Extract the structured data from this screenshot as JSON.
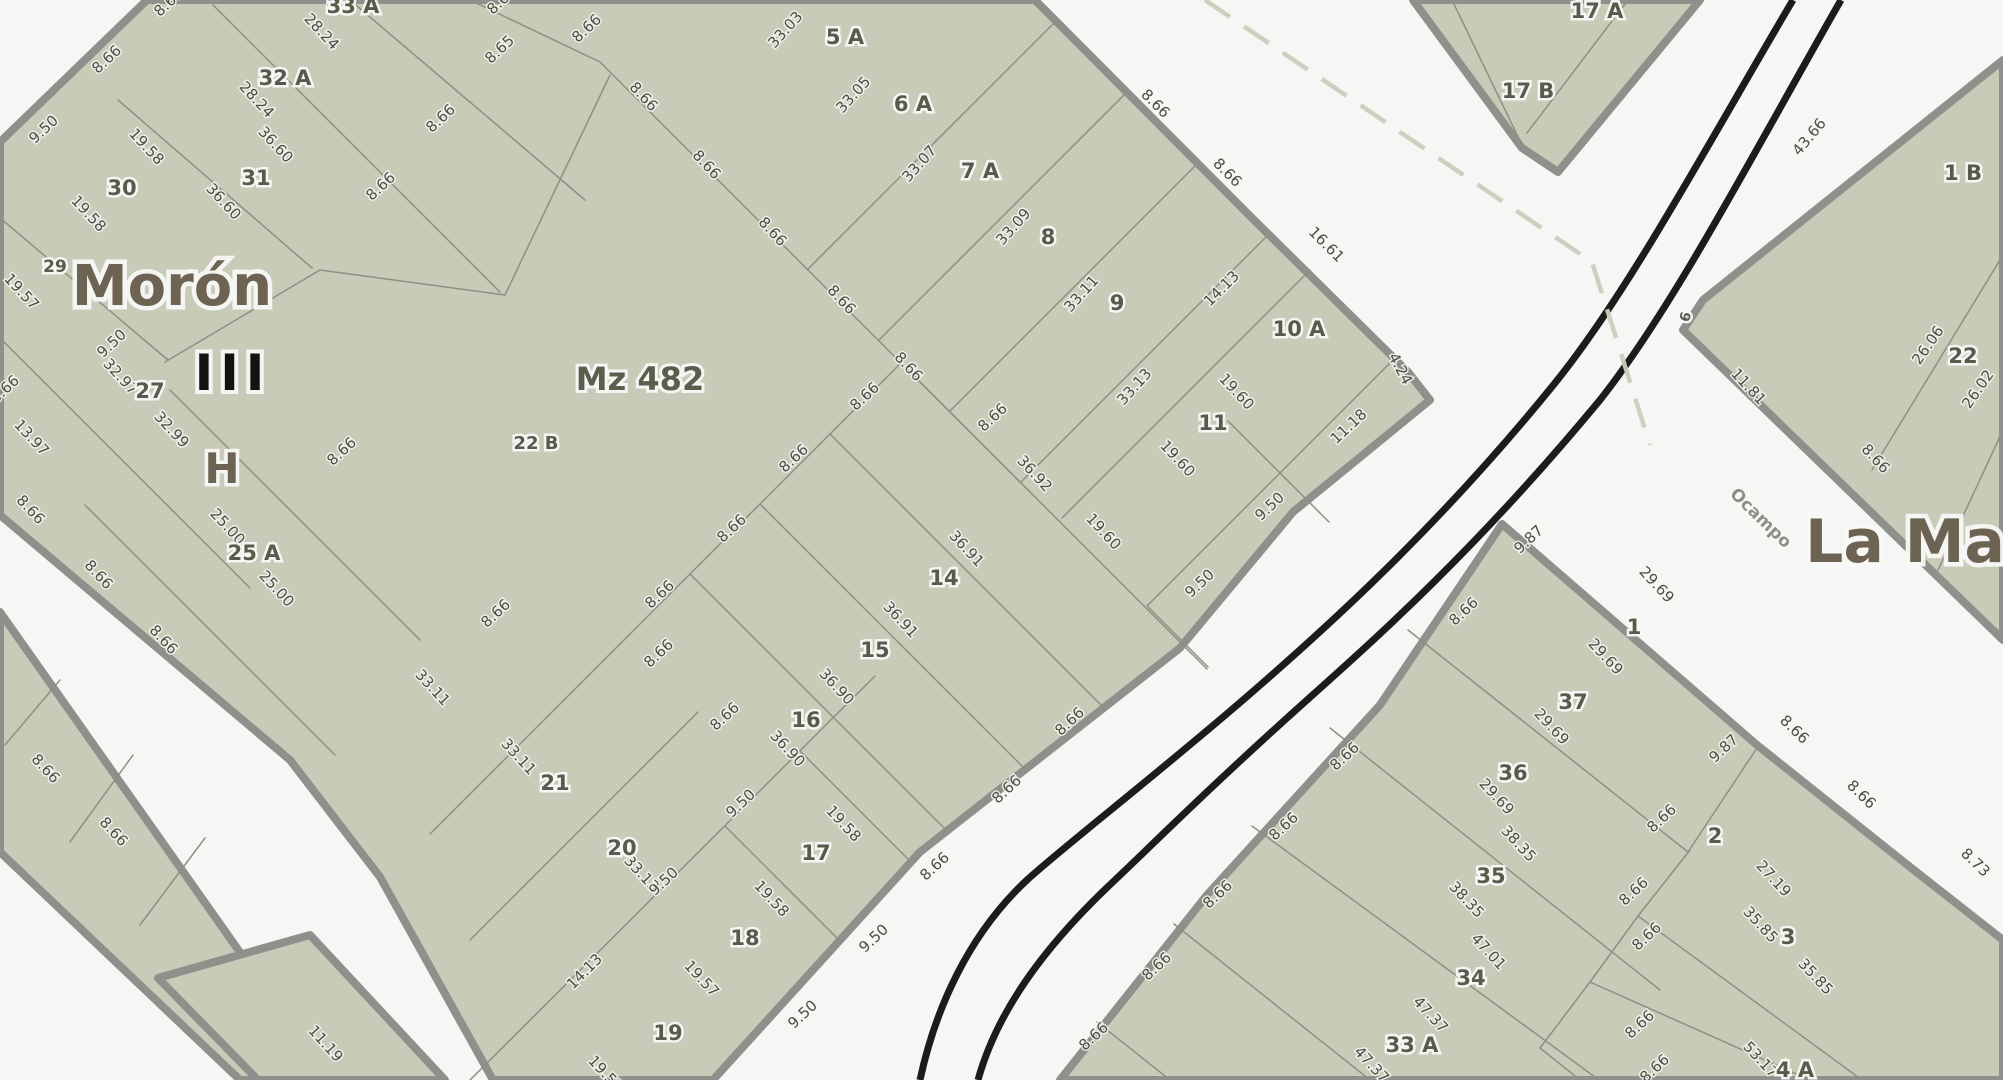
{
  "map": {
    "colors": {
      "street_bg": "#f6f6f4",
      "block_fill": "#c9cbb9",
      "block_casing": "#8f8f8b",
      "lot_line": "#8f9081",
      "railway": "#1c1c1c",
      "boundary_dash": "#c9cdbc",
      "measurement_text": "#4d4d42",
      "parcel_text": "#5a5a4c",
      "region_text": "#6d6352",
      "street_text": "#8f8f88"
    },
    "region_labels": [
      {
        "text": "Morón",
        "x": 172,
        "y": 305,
        "size": 56,
        "color": "#6d6352",
        "rot": 0,
        "halo": 9
      },
      {
        "text": "III",
        "x": 233,
        "y": 390,
        "size": 50,
        "color": "#121212",
        "rot": 0,
        "halo": 8,
        "spacing": 7
      },
      {
        "text": "H",
        "x": 222,
        "y": 483,
        "size": 42,
        "color": "#6d6352",
        "rot": 0,
        "halo": 7
      },
      {
        "text": "Mz 482",
        "x": 640,
        "y": 390,
        "size": 32,
        "color": "#5d5d4d",
        "rot": 0,
        "halo": 6
      },
      {
        "text": "La Ma",
        "x": 1905,
        "y": 562,
        "size": 60,
        "color": "#6d6352",
        "rot": 0,
        "halo": 9
      }
    ],
    "street_labels": [
      {
        "text": "Ocampo",
        "x": 1757,
        "y": 522,
        "size": 17,
        "rot": 44
      }
    ],
    "parcel_labels": [
      {
        "text": "33 A",
        "x": 353,
        "y": 13
      },
      {
        "text": "32 A",
        "x": 285,
        "y": 85
      },
      {
        "text": "31",
        "x": 256,
        "y": 185
      },
      {
        "text": "30",
        "x": 122,
        "y": 195
      },
      {
        "text": "29",
        "x": 55,
        "y": 272,
        "size": 17
      },
      {
        "text": "27",
        "x": 150,
        "y": 398
      },
      {
        "text": "25 A",
        "x": 254,
        "y": 560
      },
      {
        "text": "22 B",
        "x": 536,
        "y": 449,
        "size": 18
      },
      {
        "text": "5 A",
        "x": 845,
        "y": 44
      },
      {
        "text": "6 A",
        "x": 913,
        "y": 111
      },
      {
        "text": "7 A",
        "x": 980,
        "y": 178
      },
      {
        "text": "8",
        "x": 1048,
        "y": 244
      },
      {
        "text": "9",
        "x": 1117,
        "y": 310
      },
      {
        "text": "10 A",
        "x": 1299,
        "y": 336
      },
      {
        "text": "11",
        "x": 1213,
        "y": 430
      },
      {
        "text": "14",
        "x": 944,
        "y": 585
      },
      {
        "text": "15",
        "x": 875,
        "y": 657
      },
      {
        "text": "16",
        "x": 806,
        "y": 727
      },
      {
        "text": "17",
        "x": 816,
        "y": 860
      },
      {
        "text": "18",
        "x": 745,
        "y": 945
      },
      {
        "text": "19",
        "x": 668,
        "y": 1040
      },
      {
        "text": "20",
        "x": 622,
        "y": 855
      },
      {
        "text": "21",
        "x": 555,
        "y": 790
      },
      {
        "text": "17 A",
        "x": 1597,
        "y": 18
      },
      {
        "text": "17 B",
        "x": 1528,
        "y": 98
      },
      {
        "text": "1 B",
        "x": 1963,
        "y": 180
      },
      {
        "text": "22",
        "x": 1963,
        "y": 363
      },
      {
        "text": "6",
        "x": 1690,
        "y": 318,
        "size": 14,
        "rot": -75
      },
      {
        "text": "1",
        "x": 1634,
        "y": 634
      },
      {
        "text": "37",
        "x": 1573,
        "y": 709
      },
      {
        "text": "36",
        "x": 1513,
        "y": 780
      },
      {
        "text": "35",
        "x": 1491,
        "y": 883
      },
      {
        "text": "34",
        "x": 1471,
        "y": 985
      },
      {
        "text": "33 A",
        "x": 1412,
        "y": 1052
      },
      {
        "text": "2",
        "x": 1715,
        "y": 843
      },
      {
        "text": "3",
        "x": 1788,
        "y": 944
      },
      {
        "text": "4 A",
        "x": 1795,
        "y": 1077
      }
    ],
    "measurement_labels": [
      {
        "text": "8.66",
        "x": 172,
        "y": 6,
        "rot": -43
      },
      {
        "text": "8.66",
        "x": 110,
        "y": 63,
        "rot": -43
      },
      {
        "text": "9.50",
        "x": 47,
        "y": 133,
        "rot": -43
      },
      {
        "text": "28.24",
        "x": 318,
        "y": 35,
        "rot": 47
      },
      {
        "text": "28.24",
        "x": 253,
        "y": 103,
        "rot": 47
      },
      {
        "text": "36.60",
        "x": 272,
        "y": 148,
        "rot": 47
      },
      {
        "text": "36.60",
        "x": 220,
        "y": 205,
        "rot": 47
      },
      {
        "text": "19.58",
        "x": 143,
        "y": 150,
        "rot": 47
      },
      {
        "text": "19.58",
        "x": 85,
        "y": 217,
        "rot": 47
      },
      {
        "text": "19.57",
        "x": 18,
        "y": 295,
        "rot": 47
      },
      {
        "text": "9.50",
        "x": 115,
        "y": 347,
        "rot": -43
      },
      {
        "text": "32.97",
        "x": 117,
        "y": 380,
        "rot": 47
      },
      {
        "text": "32.99",
        "x": 168,
        "y": 433,
        "rot": 47
      },
      {
        "text": "13.97",
        "x": 28,
        "y": 441,
        "rot": 47
      },
      {
        "text": "8.66",
        "x": 8,
        "y": 393,
        "rot": -43
      },
      {
        "text": "8.66",
        "x": 444,
        "y": 122,
        "rot": -43
      },
      {
        "text": "8.66",
        "x": 384,
        "y": 190,
        "rot": -43
      },
      {
        "text": "8.65",
        "x": 503,
        "y": 53,
        "rot": -43
      },
      {
        "text": "8.66",
        "x": 505,
        "y": 4,
        "rot": -43
      },
      {
        "text": "8.66",
        "x": 590,
        "y": 32,
        "rot": -43
      },
      {
        "text": "25.00",
        "x": 224,
        "y": 530,
        "rot": 47
      },
      {
        "text": "25.00",
        "x": 273,
        "y": 592,
        "rot": 47
      },
      {
        "text": "8.66",
        "x": 345,
        "y": 455,
        "rot": -43
      },
      {
        "text": "8.66",
        "x": 27,
        "y": 513,
        "rot": 47
      },
      {
        "text": "8.66",
        "x": 95,
        "y": 578,
        "rot": 47
      },
      {
        "text": "8.66",
        "x": 160,
        "y": 643,
        "rot": 47
      },
      {
        "text": "33.03",
        "x": 789,
        "y": 33,
        "rot": -48
      },
      {
        "text": "33.05",
        "x": 857,
        "y": 98,
        "rot": -48
      },
      {
        "text": "33.07",
        "x": 923,
        "y": 167,
        "rot": -48
      },
      {
        "text": "33.09",
        "x": 1017,
        "y": 230,
        "rot": -48
      },
      {
        "text": "33.11",
        "x": 1085,
        "y": 297,
        "rot": -48
      },
      {
        "text": "33.13",
        "x": 1138,
        "y": 390,
        "rot": -48
      },
      {
        "text": "8.66",
        "x": 640,
        "y": 100,
        "rot": 47
      },
      {
        "text": "8.66",
        "x": 703,
        "y": 168,
        "rot": 47
      },
      {
        "text": "8.66",
        "x": 769,
        "y": 235,
        "rot": 47
      },
      {
        "text": "8.66",
        "x": 838,
        "y": 303,
        "rot": 47
      },
      {
        "text": "8.66",
        "x": 905,
        "y": 370,
        "rot": 47
      },
      {
        "text": "8.66",
        "x": 1152,
        "y": 107,
        "rot": 45
      },
      {
        "text": "8.66",
        "x": 1224,
        "y": 176,
        "rot": 45
      },
      {
        "text": "16.61",
        "x": 1323,
        "y": 248,
        "rot": 45
      },
      {
        "text": "14.13",
        "x": 1225,
        "y": 292,
        "rot": -45
      },
      {
        "text": "4.24",
        "x": 1396,
        "y": 371,
        "rot": 62
      },
      {
        "text": "11.18",
        "x": 1352,
        "y": 430,
        "rot": -43
      },
      {
        "text": "9.50",
        "x": 1273,
        "y": 510,
        "rot": -43
      },
      {
        "text": "9.50",
        "x": 1203,
        "y": 587,
        "rot": -43
      },
      {
        "text": "19.60",
        "x": 1233,
        "y": 395,
        "rot": 47
      },
      {
        "text": "19.60",
        "x": 1174,
        "y": 462,
        "rot": 47
      },
      {
        "text": "19.60",
        "x": 1100,
        "y": 535,
        "rot": 47
      },
      {
        "text": "36.92",
        "x": 1031,
        "y": 477,
        "rot": 47
      },
      {
        "text": "36.91",
        "x": 963,
        "y": 552,
        "rot": 47
      },
      {
        "text": "36.91",
        "x": 897,
        "y": 623,
        "rot": 47
      },
      {
        "text": "36.90",
        "x": 833,
        "y": 690,
        "rot": 47
      },
      {
        "text": "36.90",
        "x": 784,
        "y": 752,
        "rot": 47
      },
      {
        "text": "8.66",
        "x": 996,
        "y": 421,
        "rot": -43
      },
      {
        "text": "8.66",
        "x": 868,
        "y": 400,
        "rot": -43
      },
      {
        "text": "8.66",
        "x": 797,
        "y": 462,
        "rot": -43
      },
      {
        "text": "8.66",
        "x": 735,
        "y": 532,
        "rot": -43
      },
      {
        "text": "8.66",
        "x": 663,
        "y": 598,
        "rot": -43
      },
      {
        "text": "8.66",
        "x": 499,
        "y": 617,
        "rot": -43
      },
      {
        "text": "8.66",
        "x": 662,
        "y": 657,
        "rot": -43
      },
      {
        "text": "8.66",
        "x": 728,
        "y": 720,
        "rot": -43
      },
      {
        "text": "33.11",
        "x": 429,
        "y": 691,
        "rot": 47
      },
      {
        "text": "33.11",
        "x": 515,
        "y": 760,
        "rot": 47
      },
      {
        "text": "33.13",
        "x": 638,
        "y": 877,
        "rot": 47
      },
      {
        "text": "9.50",
        "x": 744,
        "y": 807,
        "rot": -43
      },
      {
        "text": "9.50",
        "x": 667,
        "y": 885,
        "rot": -43
      },
      {
        "text": "19.58",
        "x": 840,
        "y": 827,
        "rot": 47
      },
      {
        "text": "19.58",
        "x": 768,
        "y": 902,
        "rot": 47
      },
      {
        "text": "19.57",
        "x": 698,
        "y": 982,
        "rot": 47
      },
      {
        "text": "14.13",
        "x": 588,
        "y": 975,
        "rot": -45
      },
      {
        "text": "19.57",
        "x": 602,
        "y": 1077,
        "rot": 47
      },
      {
        "text": "8.66",
        "x": 1073,
        "y": 725,
        "rot": -43
      },
      {
        "text": "8.66",
        "x": 1010,
        "y": 793,
        "rot": -43
      },
      {
        "text": "8.66",
        "x": 938,
        "y": 870,
        "rot": -43
      },
      {
        "text": "9.50",
        "x": 877,
        "y": 942,
        "rot": -43
      },
      {
        "text": "9.50",
        "x": 806,
        "y": 1018,
        "rot": -43
      },
      {
        "text": "8.66",
        "x": 42,
        "y": 772,
        "rot": 47
      },
      {
        "text": "8.66",
        "x": 110,
        "y": 835,
        "rot": 47
      },
      {
        "text": "11.19",
        "x": 322,
        "y": 1047,
        "rot": 48
      },
      {
        "text": "43.66",
        "x": 1813,
        "y": 140,
        "rot": -50
      },
      {
        "text": "26.06",
        "x": 1932,
        "y": 348,
        "rot": -55
      },
      {
        "text": "26.02",
        "x": 1982,
        "y": 392,
        "rot": -55
      },
      {
        "text": "11.81",
        "x": 1745,
        "y": 390,
        "rot": 47
      },
      {
        "text": "8.66",
        "x": 1872,
        "y": 462,
        "rot": 47
      },
      {
        "text": "9.87",
        "x": 1532,
        "y": 543,
        "rot": -43
      },
      {
        "text": "8.66",
        "x": 1467,
        "y": 615,
        "rot": -43
      },
      {
        "text": "8.66",
        "x": 1348,
        "y": 760,
        "rot": -43
      },
      {
        "text": "8.66",
        "x": 1287,
        "y": 830,
        "rot": -43
      },
      {
        "text": "8.66",
        "x": 1221,
        "y": 898,
        "rot": -43
      },
      {
        "text": "8.66",
        "x": 1160,
        "y": 970,
        "rot": -43
      },
      {
        "text": "8.66",
        "x": 1097,
        "y": 1040,
        "rot": -43
      },
      {
        "text": "9.87",
        "x": 1727,
        "y": 752,
        "rot": -43
      },
      {
        "text": "8.66",
        "x": 1791,
        "y": 733,
        "rot": 44
      },
      {
        "text": "8.66",
        "x": 1858,
        "y": 798,
        "rot": 44
      },
      {
        "text": "8.73",
        "x": 1972,
        "y": 866,
        "rot": 44
      },
      {
        "text": "29.69",
        "x": 1653,
        "y": 588,
        "rot": 47
      },
      {
        "text": "29.69",
        "x": 1602,
        "y": 660,
        "rot": 47
      },
      {
        "text": "29.69",
        "x": 1548,
        "y": 730,
        "rot": 47
      },
      {
        "text": "29.69",
        "x": 1493,
        "y": 800,
        "rot": 47
      },
      {
        "text": "38.35",
        "x": 1515,
        "y": 847,
        "rot": 47
      },
      {
        "text": "38.35",
        "x": 1463,
        "y": 903,
        "rot": 47
      },
      {
        "text": "47.01",
        "x": 1485,
        "y": 955,
        "rot": 47
      },
      {
        "text": "47.37",
        "x": 1427,
        "y": 1018,
        "rot": 47
      },
      {
        "text": "47.37",
        "x": 1368,
        "y": 1068,
        "rot": 47
      },
      {
        "text": "8.66",
        "x": 1665,
        "y": 822,
        "rot": -43
      },
      {
        "text": "8.66",
        "x": 1637,
        "y": 895,
        "rot": -43
      },
      {
        "text": "8.66",
        "x": 1650,
        "y": 940,
        "rot": -43
      },
      {
        "text": "8.66",
        "x": 1643,
        "y": 1028,
        "rot": -43
      },
      {
        "text": "8.66",
        "x": 1658,
        "y": 1072,
        "rot": -43
      },
      {
        "text": "27.19",
        "x": 1770,
        "y": 882,
        "rot": 47
      },
      {
        "text": "35.85",
        "x": 1757,
        "y": 928,
        "rot": 47
      },
      {
        "text": "35.85",
        "x": 1812,
        "y": 980,
        "rot": 47
      },
      {
        "text": "53.17",
        "x": 1757,
        "y": 1063,
        "rot": 47
      }
    ],
    "blocks": [
      {
        "name": "block-mz482",
        "d": "M0,142 L147,0 L1035,0 L1252,218 L1408,372 L1430,400 L1293,512 L1180,648 L920,852 L713,1080 L493,1080 L380,877 L290,760 L0,515 Z"
      },
      {
        "name": "block-sw-strip",
        "d": "M0,612 L330,1080 L240,1080 L0,852 Z"
      },
      {
        "name": "block-sw-corner",
        "d": "M310,935 L445,1080 L258,1080 L158,978 Z"
      },
      {
        "name": "block-northeast",
        "d": "M1413,0 L1700,0 L1558,172 L1522,148 Z"
      },
      {
        "name": "block-east-1b22",
        "d": "M2003,60 L1703,300 L1683,330 L2003,640 Z"
      },
      {
        "name": "block-southeast",
        "d": "M1502,524 L1757,745 L1905,863 L2003,940 L2003,1080 L1060,1080 L1207,895 L1380,705 Z"
      }
    ],
    "inner_lines": [
      [
        600,
        62,
        1030,
        492
      ],
      [
        1056,
        21,
        808,
        269
      ],
      [
        1127,
        92,
        879,
        340
      ],
      [
        1198,
        163,
        950,
        411
      ],
      [
        1269,
        234,
        1021,
        482
      ],
      [
        1310,
        270,
        1062,
        518
      ],
      [
        1395,
        358,
        1147,
        606
      ],
      [
        1228,
        421,
        1329,
        522
      ],
      [
        1147,
        606,
        1208,
        667
      ],
      [
        901,
        363,
        430,
        834
      ],
      [
        901,
        363,
        1207,
        669
      ],
      [
        830,
        434,
        1104,
        708
      ],
      [
        760,
        504,
        1026,
        770
      ],
      [
        690,
        574,
        947,
        831
      ],
      [
        875,
        676,
        470,
        1080
      ],
      [
        800,
        751,
        911,
        862
      ],
      [
        725,
        826,
        840,
        941
      ],
      [
        698,
        712,
        470,
        940
      ],
      [
        0,
        218,
        168,
        360
      ],
      [
        118,
        100,
        312,
        268
      ],
      [
        213,
        5,
        500,
        292
      ],
      [
        350,
        0,
        585,
        200
      ],
      [
        470,
        0,
        600,
        62
      ],
      [
        165,
        362,
        320,
        270
      ],
      [
        320,
        270,
        505,
        295
      ],
      [
        505,
        295,
        610,
        75
      ],
      [
        0,
        338,
        250,
        588
      ],
      [
        170,
        390,
        420,
        640
      ],
      [
        85,
        505,
        335,
        755
      ],
      [
        60,
        680,
        5,
        745
      ],
      [
        133,
        755,
        70,
        842
      ],
      [
        205,
        838,
        140,
        925
      ],
      [
        1628,
        0,
        1527,
        133
      ],
      [
        1452,
        0,
        1521,
        143
      ],
      [
        1872,
        470,
        2003,
        255
      ],
      [
        1938,
        570,
        2003,
        430
      ],
      [
        1408,
        630,
        1688,
        852
      ],
      [
        1688,
        852,
        1757,
        748
      ],
      [
        1330,
        728,
        1660,
        990
      ],
      [
        1252,
        826,
        1599,
        1080
      ],
      [
        1174,
        924,
        1370,
        1080
      ],
      [
        1097,
        1022,
        1170,
        1080
      ],
      [
        1690,
        850,
        1638,
        916
      ],
      [
        1638,
        916,
        1862,
        1080
      ],
      [
        1638,
        916,
        1590,
        982
      ],
      [
        1590,
        982,
        1810,
        1080
      ],
      [
        1590,
        982,
        1540,
        1048
      ],
      [
        1540,
        1048,
        1580,
        1080
      ]
    ],
    "railway_paths": [
      "M1793,0 C1710,140 1630,290 1555,383 C1440,525 1330,625 1243,700 C1150,780 1062,848 1027,880 C968,935 935,1010 920,1080",
      "M1841,0 C1755,150 1675,305 1600,400 C1480,545 1380,635 1307,700 C1212,785 1152,845 1115,880 C1040,950 996,1015 978,1080"
    ],
    "boundary_paths": [
      "M1205,0 L1592,262 L1650,445"
    ]
  }
}
